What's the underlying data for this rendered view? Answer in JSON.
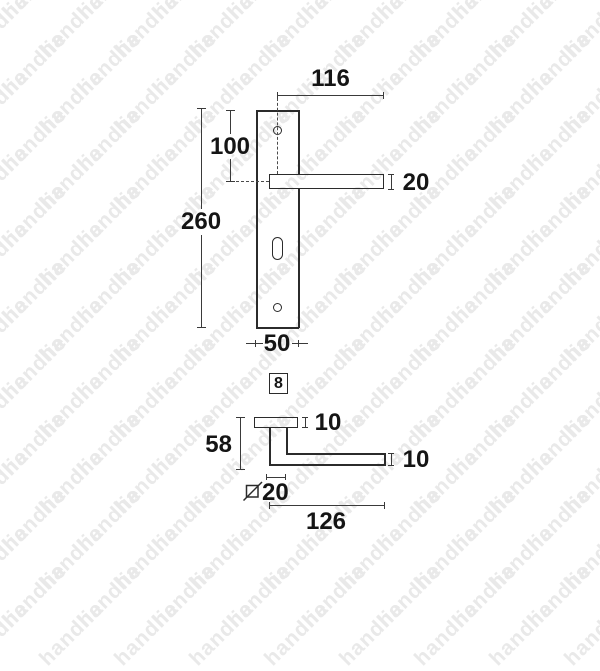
{
  "colors": {
    "background": "#ffffff",
    "line": "#2b2b2b",
    "dim_text": "#151515",
    "watermark": "#e9e9e9"
  },
  "watermark": {
    "text": "handlie"
  },
  "front_view": {
    "dims": {
      "handle_length": "116",
      "hole_to_handle": "100",
      "plate_height": "260",
      "handle_thickness": "20",
      "plate_width": "50",
      "spindle": "8"
    }
  },
  "side_view": {
    "dims": {
      "rose_depth": "10",
      "projection": "58",
      "grip_thickness": "10",
      "neck_square": "20",
      "handle_length": "126"
    }
  }
}
